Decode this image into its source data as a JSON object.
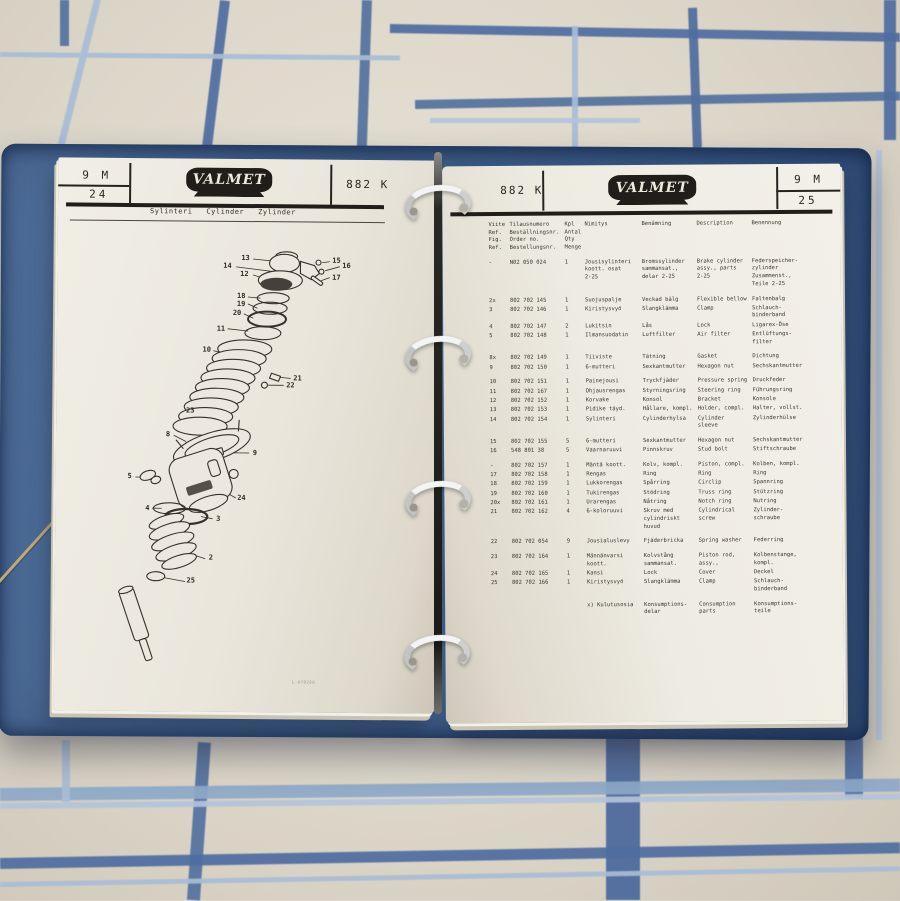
{
  "colors": {
    "binder_blue": "#45658f",
    "binder_edge": "#27456e",
    "sheet_cream": "#ddd7ca",
    "plaid_dark": "#4f6da0",
    "plaid_light": "#a9bdd6",
    "page_white": "#ece8df",
    "ink": "#2a2722",
    "logo_black": "#211d18",
    "ring_silver": "#dddddd"
  },
  "left_page": {
    "header": {
      "page_group": "9 M",
      "page_number": "24",
      "brand": "VALMET",
      "code": "882 K"
    },
    "subtitle": {
      "fi": "Sylinteri",
      "en": "Cylinder",
      "de": "Zylinder"
    },
    "diagram": {
      "labels": [
        "13",
        "14",
        "12",
        "15",
        "16",
        "17",
        "18",
        "19",
        "20",
        "11",
        "10",
        "21",
        "22",
        "23",
        "8",
        "9",
        "5",
        "24",
        "4",
        "3",
        "2",
        "25"
      ]
    },
    "drawing_ref": "L-870286"
  },
  "right_page": {
    "header": {
      "code": "882 K",
      "brand": "VALMET",
      "page_group": "9 M",
      "page_number": "25"
    },
    "table": {
      "headers": {
        "ref": "Viite\nRef.\nFig.\nRef.",
        "no": "Tilausnumero\nBeställningsnr.\nOrder no.\nBestellungsnr.",
        "qty": "Kpl\nAntal\nQty\nMenge",
        "fi": "Nimitys",
        "sv": "Benämning",
        "en": "Description",
        "de": "Benennung"
      },
      "rows": [
        {
          "ref": "-",
          "no": "N02 050 024",
          "qty": "1",
          "fi": "Jousisylinteri\nkoott. osat\n2-25",
          "sv": "Bromssylinder\nsammansat.,\ndelar 2-25",
          "en": "Brake cylinder\nassy., parts\n2-25",
          "de": "Federspeicher-\nzylinder\nZusammenst.,\nTeile 2-25",
          "gap": false
        },
        {
          "ref": "2x",
          "no": "802 702 145",
          "qty": "1",
          "fi": "Suojuspalje",
          "sv": "Veckad bälg",
          "en": "Flexible bellow",
          "de": "Faltenbalg",
          "gap": true
        },
        {
          "ref": "3",
          "no": "802 702 146",
          "qty": "1",
          "fi": "Kiristysvyö",
          "sv": "Slangklämma",
          "en": "Clamp",
          "de": "Schlauch-\nbinderband",
          "gap": false
        },
        {
          "ref": "4",
          "no": "802 702 147",
          "qty": "2",
          "fi": "Lukitsin",
          "sv": "Lås",
          "en": "Lock",
          "de": "Ligarex-Öse",
          "gap": false
        },
        {
          "ref": "5",
          "no": "802 702 148",
          "qty": "1",
          "fi": "Ilmansuodatin",
          "sv": "Luftfilter",
          "en": "Air filter",
          "de": "Entlüftungs-\nfilter",
          "gap": false
        },
        {
          "ref": "8x",
          "no": "802 702 149",
          "qty": "1",
          "fi": "Tiiviste",
          "sv": "Tätning",
          "en": "Gasket",
          "de": "Dichtung",
          "gap": true
        },
        {
          "ref": "9",
          "no": "802 702 150",
          "qty": "1",
          "fi": "6-mutteri",
          "sv": "Sexkantmutter",
          "en": "Hexagon nut",
          "de": "Sechskantmutter",
          "gap": false
        },
        {
          "ref": "10",
          "no": "802 702 151",
          "qty": "1",
          "fi": "Painejousi",
          "sv": "Tryckfjäder",
          "en": "Pressure spring",
          "de": "Druckfeder",
          "gap": true
        },
        {
          "ref": "11",
          "no": "802 702 167",
          "qty": "1",
          "fi": "Ohjausrengas",
          "sv": "Styrningsring",
          "en": "Steering ring",
          "de": "Führungsring",
          "gap": false
        },
        {
          "ref": "12",
          "no": "802 702 152",
          "qty": "1",
          "fi": "Korvake",
          "sv": "Konsol",
          "en": "Bracket",
          "de": "Konsole",
          "gap": false
        },
        {
          "ref": "13",
          "no": "802 702 153",
          "qty": "1",
          "fi": "Pidike täyd.",
          "sv": "Hållare, kompl.",
          "en": "Holder, compl.",
          "de": "Halter, vollst.",
          "gap": false
        },
        {
          "ref": "14",
          "no": "802 702 154",
          "qty": "1",
          "fi": "Sylinteri",
          "sv": "Cylinderhylsa",
          "en": "Cylinder\nsleeve",
          "de": "Zylinderhülse",
          "gap": false
        },
        {
          "ref": "15",
          "no": "802 702 155",
          "qty": "5",
          "fi": "6-mutteri",
          "sv": "Sexkantmutter",
          "en": "Hexagon nut",
          "de": "Sechskantmutter",
          "gap": true
        },
        {
          "ref": "16",
          "no": "548 801 38",
          "qty": "5",
          "fi": "Vaarnaruuvi",
          "sv": "Pinnskruv",
          "en": "Stud bolt",
          "de": "Stiftschraube",
          "gap": false
        },
        {
          "ref": "-",
          "no": "802 702 157",
          "qty": "1",
          "fi": "Mäntä koott.",
          "sv": "Kolv, kompl.",
          "en": "Piston, compl.",
          "de": "Kolben, kompl.",
          "gap": true
        },
        {
          "ref": "17",
          "no": "802 702 158",
          "qty": "1",
          "fi": "Rengas",
          "sv": "Ring",
          "en": "Ring",
          "de": "Ring",
          "gap": false
        },
        {
          "ref": "18",
          "no": "802 702 159",
          "qty": "1",
          "fi": "Lukkorengas",
          "sv": "Spårring",
          "en": "Circlip",
          "de": "Spannring",
          "gap": false
        },
        {
          "ref": "19",
          "no": "802 702 160",
          "qty": "1",
          "fi": "Tukirengas",
          "sv": "Stödring",
          "en": "Truss ring",
          "de": "Stützring",
          "gap": false
        },
        {
          "ref": "20x",
          "no": "802 702 161",
          "qty": "1",
          "fi": "Urarengas",
          "sv": "Nåtring",
          "en": "Notch ring",
          "de": "Nutring",
          "gap": false
        },
        {
          "ref": "21",
          "no": "802 702 162",
          "qty": "4",
          "fi": "6-koloruuvi",
          "sv": "Skruv med\ncylindriskt\nhuvud",
          "en": "Cylindrical\nscrew",
          "de": "Zylinder-\nschraube",
          "gap": false
        },
        {
          "ref": "22",
          "no": "802 702 054",
          "qty": "9",
          "fi": "Jousialuslevy",
          "sv": "Fjäderbricka",
          "en": "Spring washer",
          "de": "Federring",
          "gap": true
        },
        {
          "ref": "23",
          "no": "802 702 164",
          "qty": "1",
          "fi": "Männänvarsi\nkoott.",
          "sv": "Kolvstång\nsammansat.",
          "en": "Piston rod,\nassy.,",
          "de": "Kolbenstange,\nkompl.",
          "gap": true
        },
        {
          "ref": "24",
          "no": "802 702 165",
          "qty": "1",
          "fi": "Kansi",
          "sv": "Lock",
          "en": "Cover",
          "de": "Deckel",
          "gap": false
        },
        {
          "ref": "25",
          "no": "802 702 166",
          "qty": "1",
          "fi": "Kiristysvyö",
          "sv": "Slangklämma",
          "en": "Clamp",
          "de": "Schlauch-\nbinderband",
          "gap": false
        },
        {
          "ref": "",
          "no": "",
          "qty": "",
          "fi": "x) Kulutusosia",
          "sv": "Konsumptions-\ndelar",
          "en": "Consumption\nparts",
          "de": "Konsumptions-\nteile",
          "gap": true
        }
      ]
    }
  }
}
